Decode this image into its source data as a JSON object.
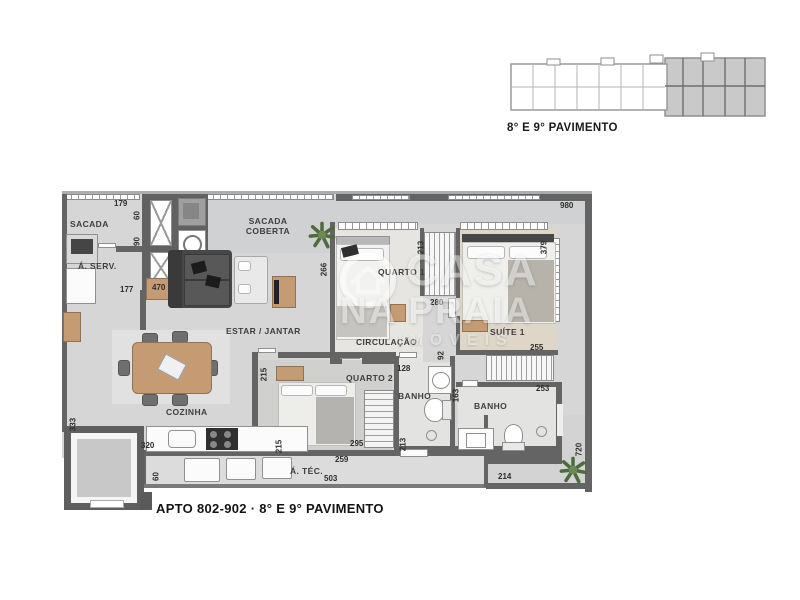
{
  "key_plan": {
    "caption": "8° E 9° PAVIMENTO"
  },
  "footer": {
    "caption": "APTO 802-902 · 8° E 9° PAVIMENTO"
  },
  "watermark": {
    "brand_top": "CASA",
    "brand_bottom": "NA PRAIA",
    "brand_sub": "IMÓVEIS"
  },
  "rooms": {
    "sacada": {
      "label": "SACADA"
    },
    "a_serv": {
      "label": "Á. SERV."
    },
    "sacada_coberta": {
      "label": "SACADA\nCOBERTA"
    },
    "quarto1": {
      "label": "QUARTO 1"
    },
    "suite1": {
      "label": "SUÍTE 1"
    },
    "estar_jantar": {
      "label": "ESTAR / JANTAR"
    },
    "circulacao": {
      "label": "CIRCULAÇÃO"
    },
    "quarto2": {
      "label": "QUARTO 2"
    },
    "banho1": {
      "label": "BANHO"
    },
    "banho2": {
      "label": "BANHO"
    },
    "cozinha": {
      "label": "COZINHA"
    },
    "a_tec": {
      "label": "Á. TÉC."
    }
  },
  "dims": [
    "179",
    "60",
    "90",
    "177",
    "470",
    "266",
    "213",
    "379",
    "980",
    "280",
    "92",
    "128",
    "163",
    "253",
    "255",
    "295",
    "213",
    "259",
    "214",
    "720",
    "333",
    "320",
    "60",
    "503",
    "215",
    "215"
  ],
  "colors": {
    "wall": "#646464",
    "floor": "#d6d6d6",
    "suite_floor": "#ded7c8",
    "wood": "#c49b73",
    "keyplan_shade": "#c9c9c9"
  }
}
